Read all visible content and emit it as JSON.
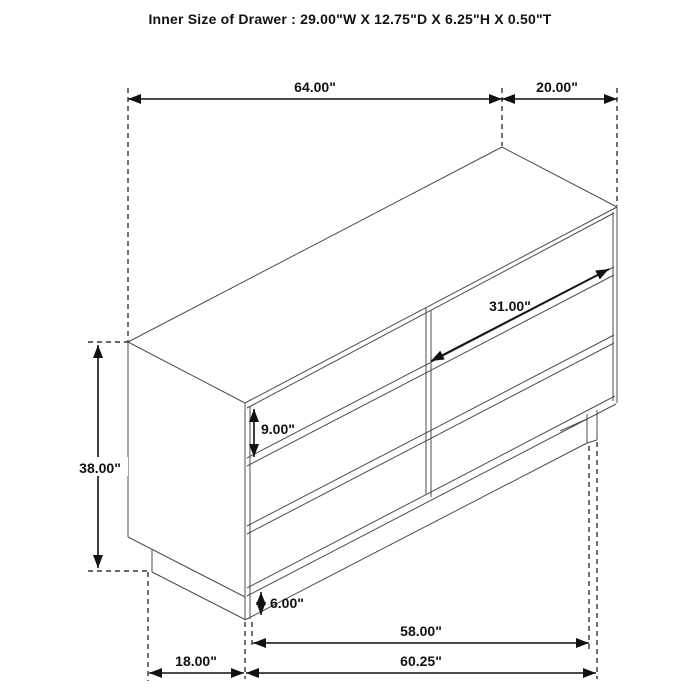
{
  "title": "Inner Size of Drawer : 29.00\"W X 12.75\"D X 6.25\"H X 0.50\"T",
  "dimensions": {
    "top_width": "64.00\"",
    "top_depth": "20.00\"",
    "overall_height": "38.00\"",
    "drawer_width": "31.00\"",
    "drawer_front_height": "9.00\"",
    "base_height": "6.00\"",
    "base_front_width": "58.00\"",
    "base_side_depth": "18.00\"",
    "base_total_width": "60.25\""
  },
  "colors": {
    "background": "#ffffff",
    "furniture_line": "#4d4d4d",
    "dimension_line": "#111111",
    "text": "#111111"
  }
}
